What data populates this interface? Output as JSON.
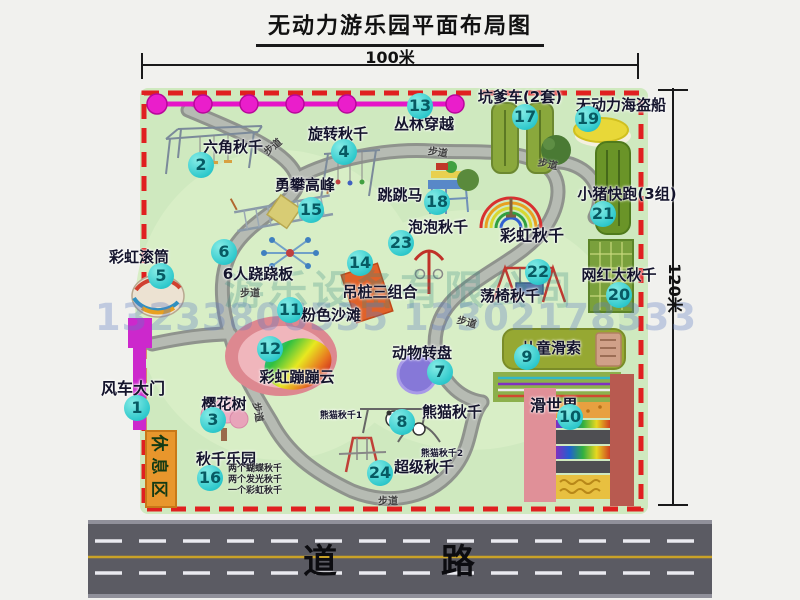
{
  "title": "无动力游乐园平面布局图",
  "dimensions": {
    "width_label": "100米",
    "height_label": "120米"
  },
  "road": {
    "label": "道 路"
  },
  "watermark": {
    "company": "游乐设备有限公司",
    "phone": "13233806535 13302178333"
  },
  "colors": {
    "park_green": "#cfe9bf",
    "border_red": "#e02020",
    "path_gray": "#9aa09c",
    "badge_cyan": "#2fc9cc",
    "zipline_magenta": "#e614c8",
    "gate_magenta": "#cc28cc",
    "rest_orange": "#e8962c",
    "road_gray": "#5b5b63",
    "road_yellow": "#c9a227"
  },
  "park": {
    "rest_area_label": "休息区",
    "attractions": [
      {
        "num": 1,
        "label": "风车大门",
        "badge": [
          137,
          408
        ],
        "label_pos": [
          133,
          375
        ],
        "size": 16
      },
      {
        "num": 2,
        "label": "六角秋千",
        "badge": [
          201,
          165
        ],
        "label_pos": [
          233,
          136
        ]
      },
      {
        "num": 3,
        "label": "樱花树",
        "badge": [
          213,
          420
        ],
        "label_pos": [
          224,
          393
        ]
      },
      {
        "num": 4,
        "label": "旋转秋千",
        "badge": [
          344,
          152
        ],
        "label_pos": [
          338,
          123
        ]
      },
      {
        "num": 5,
        "label": "彩虹滚筒",
        "badge": [
          161,
          276
        ],
        "label_pos": [
          139,
          246
        ]
      },
      {
        "num": 6,
        "label": "6人跷跷板",
        "badge": [
          224,
          252
        ],
        "label_pos": [
          258,
          263
        ]
      },
      {
        "num": 7,
        "label": "动物转盘",
        "badge": [
          440,
          372
        ],
        "label_pos": [
          422,
          342
        ]
      },
      {
        "num": 8,
        "label": "熊猫秋千",
        "badge": [
          402,
          422
        ],
        "label_pos": [
          452,
          401
        ]
      },
      {
        "num": 9,
        "label": "儿童滑索",
        "badge": [
          527,
          357
        ],
        "label_pos": [
          551,
          337
        ]
      },
      {
        "num": 10,
        "label": "滑世界",
        "badge": [
          570,
          417
        ],
        "label_pos": [
          554,
          392
        ],
        "size": 16
      },
      {
        "num": 11,
        "label": "粉色沙滩",
        "badge": [
          290,
          310
        ],
        "label_pos": [
          331,
          304
        ]
      },
      {
        "num": 12,
        "label": "彩虹蹦蹦云",
        "badge": [
          270,
          349
        ],
        "label_pos": [
          297,
          366
        ]
      },
      {
        "num": 13,
        "label": "丛林穿越",
        "badge": [
          420,
          106
        ],
        "label_pos": [
          424,
          113
        ]
      },
      {
        "num": 14,
        "label": "吊桩三组合",
        "badge": [
          360,
          263
        ],
        "label_pos": [
          380,
          281
        ]
      },
      {
        "num": 15,
        "label": "勇攀高峰",
        "badge": [
          311,
          210
        ],
        "label_pos": [
          305,
          174
        ]
      },
      {
        "num": 16,
        "label": "秋千乐园",
        "badge": [
          210,
          478
        ],
        "label_pos": [
          226,
          448
        ],
        "notes": [
          "两个蝴蝶秋千",
          "两个发光秋千",
          "一个彩虹秋千"
        ],
        "notes_pos": [
          228,
          464
        ]
      },
      {
        "num": 17,
        "label": "坑爹车(2套)",
        "badge": [
          525,
          117
        ],
        "label_pos": [
          520,
          86
        ]
      },
      {
        "num": 18,
        "label": "跳跳马",
        "badge": [
          437,
          202
        ],
        "label_pos": [
          400,
          184
        ]
      },
      {
        "num": 19,
        "label": "无动力海盗船",
        "badge": [
          588,
          119
        ],
        "label_pos": [
          621,
          94
        ]
      },
      {
        "num": 20,
        "label": "网红大秋千",
        "badge": [
          619,
          295
        ],
        "label_pos": [
          619,
          264
        ]
      },
      {
        "num": 21,
        "label": "小猪快跑(3组)",
        "badge": [
          603,
          214
        ],
        "label_pos": [
          627,
          183
        ]
      },
      {
        "num": 22,
        "label": "荡椅秋千",
        "badge": [
          538,
          272
        ],
        "label_pos": [
          510,
          285
        ]
      },
      {
        "num": 23,
        "label": "泡泡秋千",
        "badge": [
          401,
          243
        ],
        "label_pos": [
          438,
          216
        ]
      },
      {
        "num": 24,
        "label": "超级秋千",
        "badge": [
          380,
          473
        ],
        "label_pos": [
          424,
          456
        ]
      }
    ],
    "extra_labels": [
      {
        "text": "彩虹秋千",
        "x": 532,
        "y": 222,
        "size": 16
      },
      {
        "text": "熊猫秋千1",
        "x": 341,
        "y": 408,
        "size": 9
      },
      {
        "text": "熊猫秋千2",
        "x": 442,
        "y": 446,
        "size": 9
      }
    ],
    "path_labels": [
      {
        "text": "步道",
        "x": 272,
        "y": 146,
        "rot": -40
      },
      {
        "text": "步道",
        "x": 438,
        "y": 151,
        "rot": 8
      },
      {
        "text": "步道",
        "x": 548,
        "y": 163,
        "rot": 12
      },
      {
        "text": "步道",
        "x": 250,
        "y": 292,
        "rot": 0
      },
      {
        "text": "步道",
        "x": 467,
        "y": 321,
        "rot": 15
      },
      {
        "text": "步道",
        "x": 259,
        "y": 412,
        "rot": 80
      },
      {
        "text": "步道",
        "x": 388,
        "y": 500,
        "rot": 0
      }
    ]
  }
}
